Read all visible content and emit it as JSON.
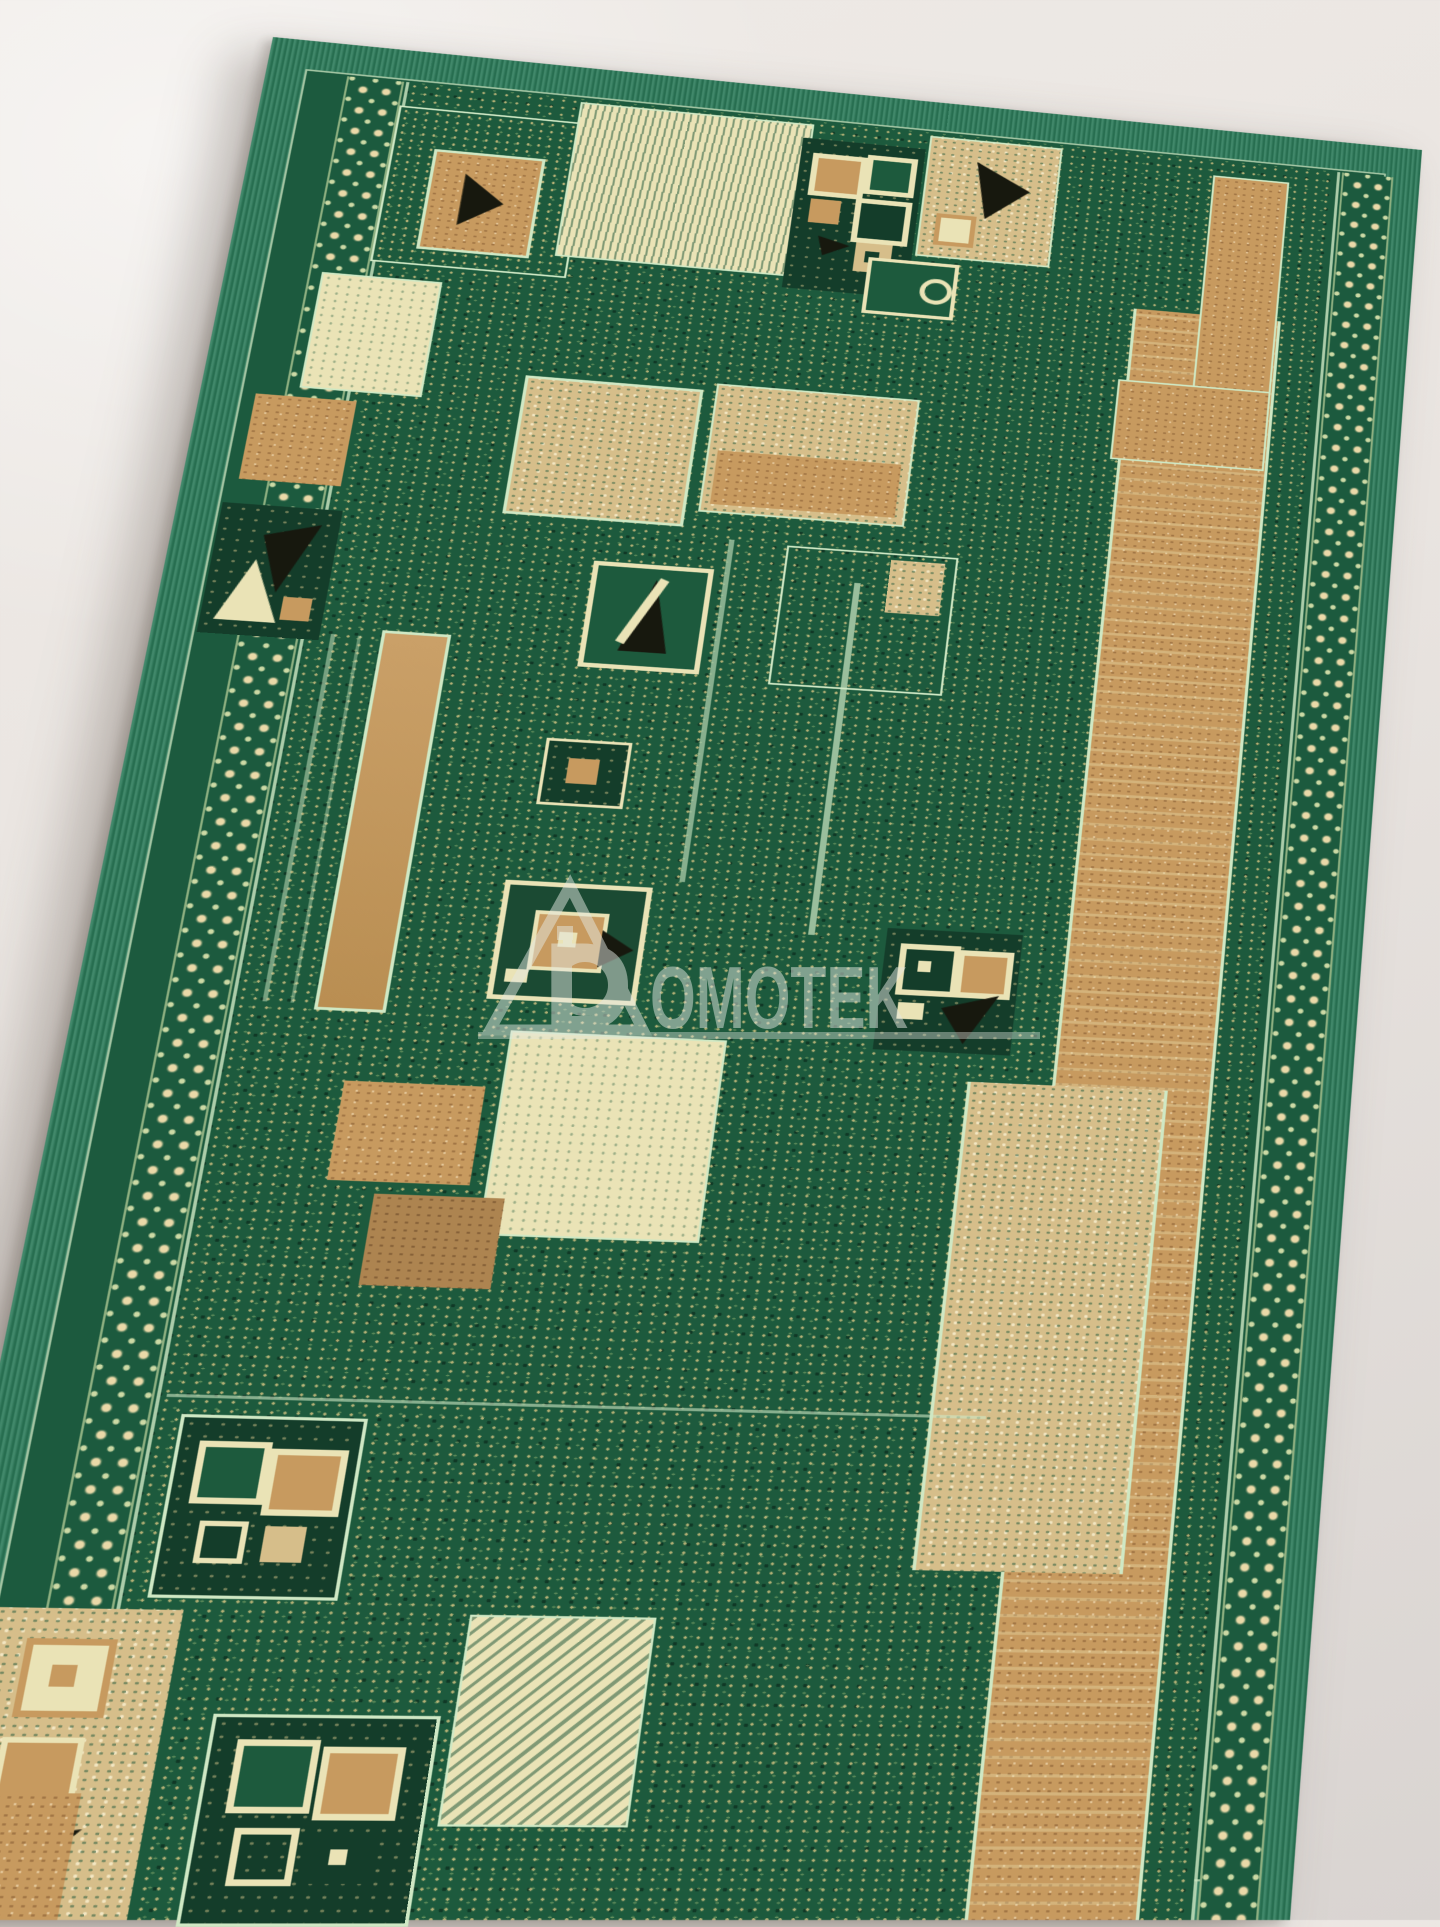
{
  "image": {
    "type": "product-photo",
    "subject": "Green runner rug with geometric beige, cream, tan and black patchwork pattern, laid at an angle on a light floor"
  },
  "watermark": {
    "letter_d": "D",
    "text": "OMOTEK",
    "logo": "triangle-microscope-logo",
    "underline": true,
    "color": "#e4e8e1",
    "opacity": 0.5
  },
  "palette": {
    "floor-light": "#efebe7",
    "floor-mid": "#e9e4e0",
    "floor-dark": "#d9d4d1",
    "selvedge": "#2b7a59",
    "border-band": "#1c5a3e",
    "field": "#1d5a3d",
    "mint": "#cfe8c4",
    "cream": "#eae3b6",
    "beige": "#d6be8a",
    "tan": "#c79a5f",
    "brown": "#ad8450",
    "dark-block": "#143d2a",
    "black-accent": "#17180e",
    "chain-cream": "#ead9a8"
  },
  "rug": {
    "shape": "runner",
    "pattern": "geometric patchwork of rectangles, small squares and black triangle accents",
    "colors": [
      "green",
      "beige",
      "cream",
      "tan",
      "black"
    ]
  }
}
